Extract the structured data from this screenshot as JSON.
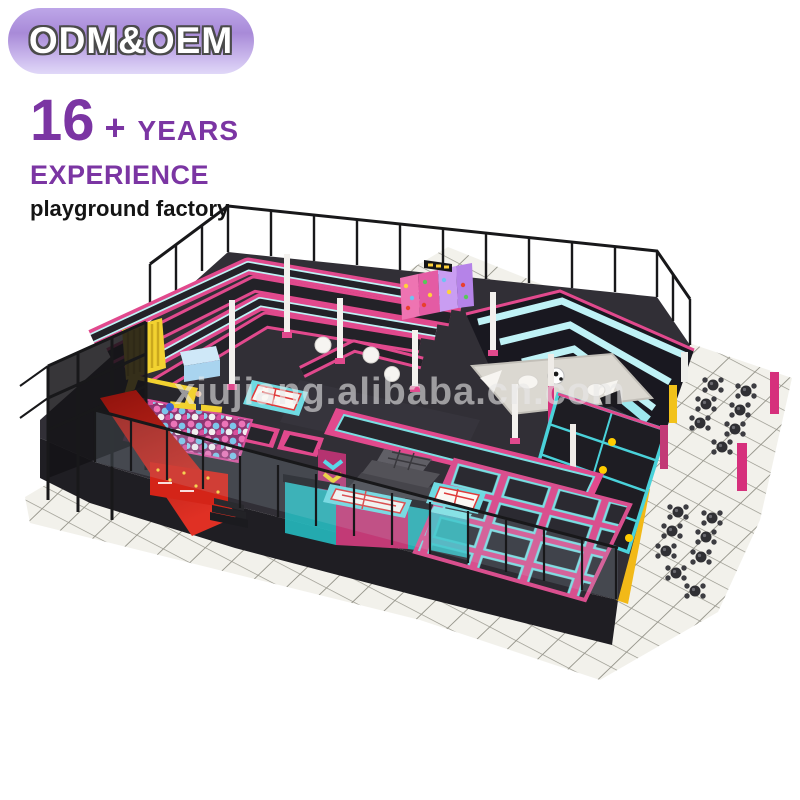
{
  "badge": {
    "label": "ODM&OEM"
  },
  "headline": {
    "number": "16",
    "plus": "+",
    "suffix": "YEARS"
  },
  "subheadline": "EXPERIENCE",
  "tagline": "playground factory",
  "watermark": "xiujiang.alibaba.cn.com",
  "illustration": {
    "alt": "Isometric 3D render of an indoor trampoline park: pink-framed trampoline maze, ball pit with red slide and black tower, yellow climbing wall, dotted rock-climbing wall, cyan chevron bleachers, white foam pit with soccer ball, dodgeball court with yellow balls, center trampoline grid, air-track mats, gray foam blocks, teal and magenta booths, black perimeter railing and cafe tables on a white tiled floor"
  },
  "palette": {
    "purple": "#7b35a3",
    "pink": "#e1498d",
    "magenta": "#c23a76",
    "cyan": "#bff2f6",
    "teal": "#2cc5c9",
    "yellow": "#f2d230",
    "gold": "#f2b918",
    "red": "#d42418",
    "platform": "#312f36",
    "face": "#1f1e23",
    "fence": "#18181a",
    "tile": "#f2f1eb",
    "grout": "#98978d",
    "violet": "#b583e8",
    "ball-blue": "#7cc6ea",
    "ball-pink": "#ec74b8"
  }
}
